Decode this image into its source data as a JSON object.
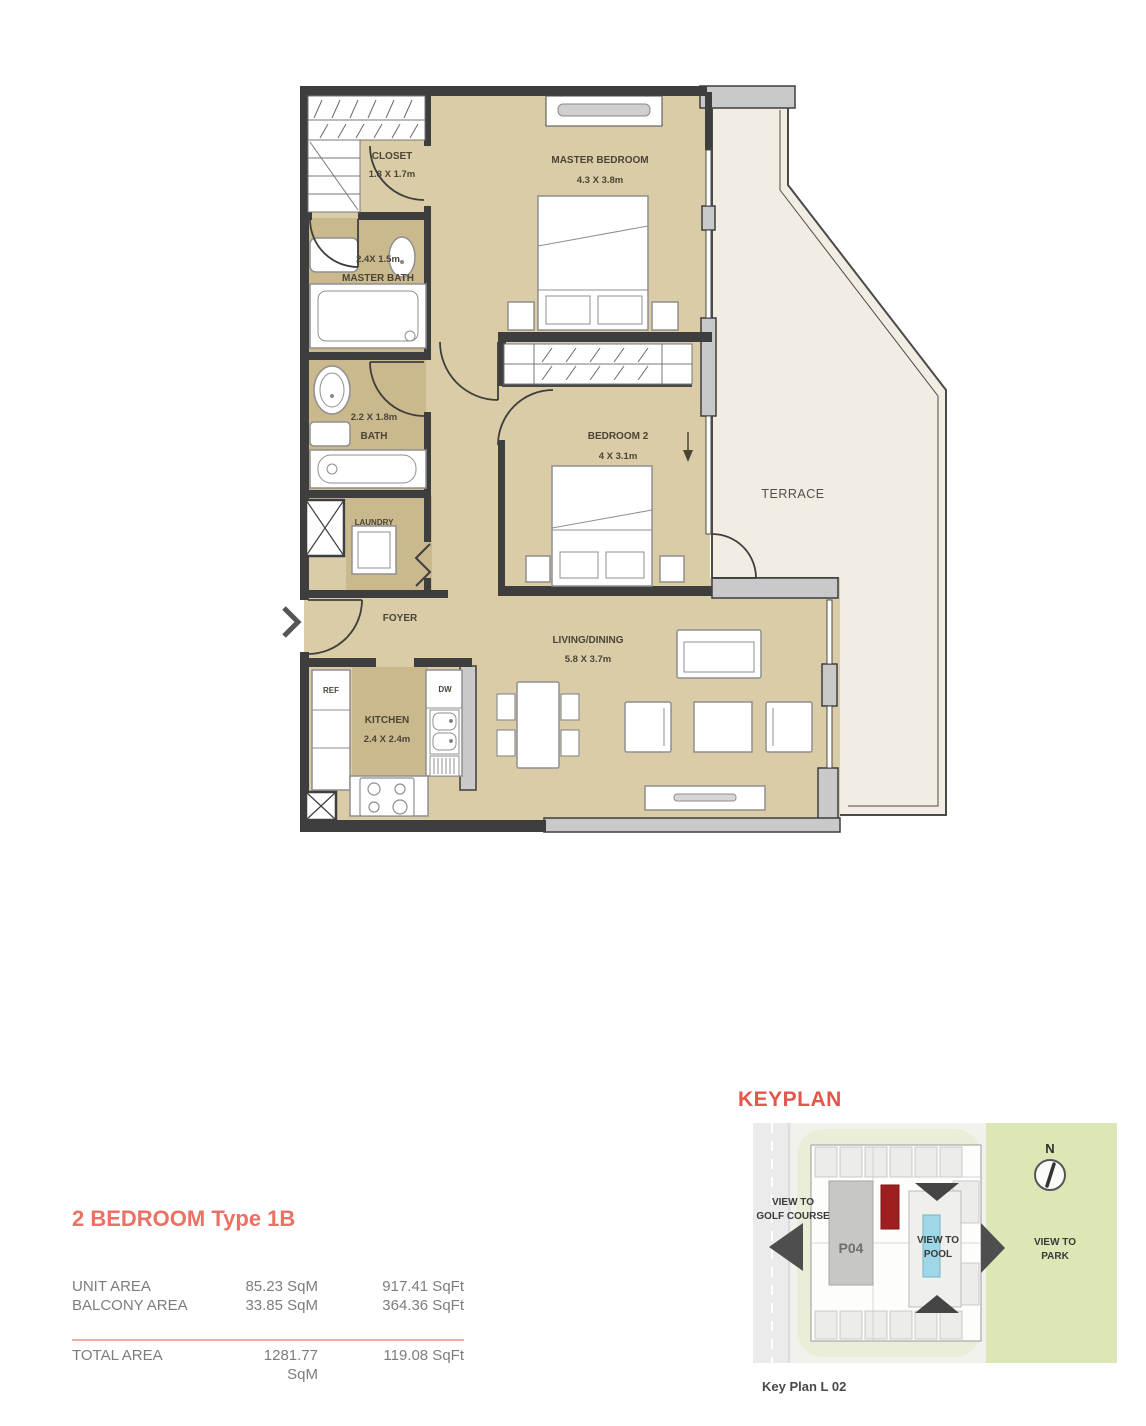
{
  "unit": {
    "title": "2 BEDROOM Type 1B",
    "area_table": {
      "rows": [
        {
          "label": "UNIT AREA",
          "sqm": "85.23 SqM",
          "sqft": "917.41 SqFt"
        },
        {
          "label": "BALCONY AREA",
          "sqm": "33.85 SqM",
          "sqft": "364.36 SqFt"
        }
      ],
      "total": {
        "label": "TOTAL AREA",
        "sqm": "1281.77 SqM",
        "sqft": "119.08 SqFt"
      }
    }
  },
  "floorplan": {
    "rooms": {
      "closet": {
        "name": "CLOSET",
        "dims": "1.8 X 1.7m"
      },
      "master_bath": {
        "name": "MASTER BATH",
        "dims": "2.4X 1.5m"
      },
      "master_bedroom": {
        "name": "MASTER BEDROOM",
        "dims": "4.3 X 3.8m"
      },
      "bath": {
        "name": "BATH",
        "dims": "2.2 X 1.8m"
      },
      "laundry": {
        "name": "LAUNDRY"
      },
      "bedroom2": {
        "name": "BEDROOM 2",
        "dims": "4 X 3.1m"
      },
      "foyer": {
        "name": "FOYER"
      },
      "kitchen": {
        "name": "KITCHEN",
        "dims": "2.4 X 2.4m"
      },
      "living_dining": {
        "name": "LIVING/DINING",
        "dims": "5.8 X 3.7m"
      },
      "terrace": {
        "name": "TERRACE"
      }
    },
    "appliances": {
      "fridge": "REF",
      "dishwasher": "DW"
    }
  },
  "keyplan": {
    "title": "KEYPLAN",
    "caption": "Key Plan L 02",
    "building_label": "P04",
    "north_label": "N",
    "view_golf_line1": "VIEW TO",
    "view_golf_line2": "GOLF COURSE",
    "view_pool_line1": "VIEW TO",
    "view_pool_line2": "POOL",
    "view_park_line1": "VIEW TO",
    "view_park_line2": "PARK"
  },
  "colors": {
    "accent_salmon": "#ec7164",
    "room_fill": "#d9cca6",
    "wet_room_fill": "#cbb98e",
    "terrace_fill": "#f2ede2",
    "wall": "#3e3e3e",
    "pier": "#c9c9c9",
    "keyplan_green": "#dbe7b4",
    "keyplan_pool": "#9fd6e8",
    "keyplan_unit_red": "#9e1f1f"
  }
}
